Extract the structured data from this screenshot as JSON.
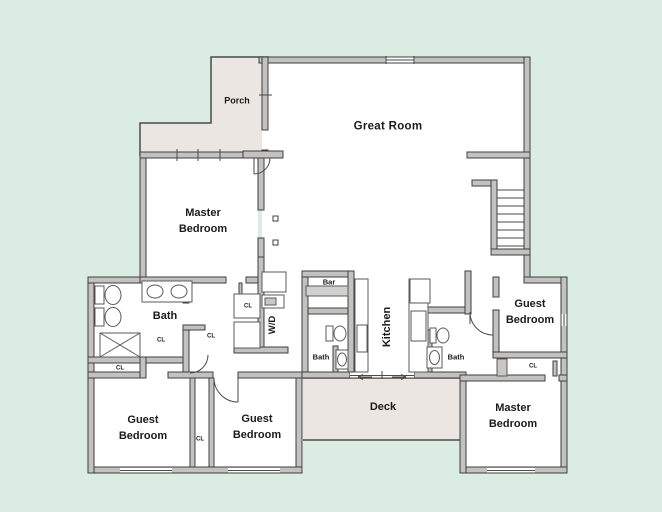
{
  "plan": {
    "type": "residential-floor-plan",
    "labels": {
      "porch": "Porch",
      "great_room": "Great Room",
      "master_bedroom_upper": "Master Bedroom",
      "bath_left": "Bath",
      "wd": "W/D",
      "bar": "Bar",
      "bath_center": "Bath",
      "kitchen": "Kitchen",
      "bath_right": "Bath",
      "guest_bedroom_right": "Guest Bedroom",
      "master_bedroom_lower": "Master Bedroom",
      "deck": "Deck",
      "guest_bedroom_left": "Guest Bedroom",
      "guest_bedroom_center": "Guest Bedroom",
      "closet": "CL"
    },
    "colors": {
      "background": "#dbece2",
      "wall_fill": "#c3c2c1",
      "wall_line": "#3f3f3f",
      "porch_deck_fill": "#ebe6e1",
      "room_fill": "#ffffff",
      "text": "#1b1b1b"
    }
  }
}
